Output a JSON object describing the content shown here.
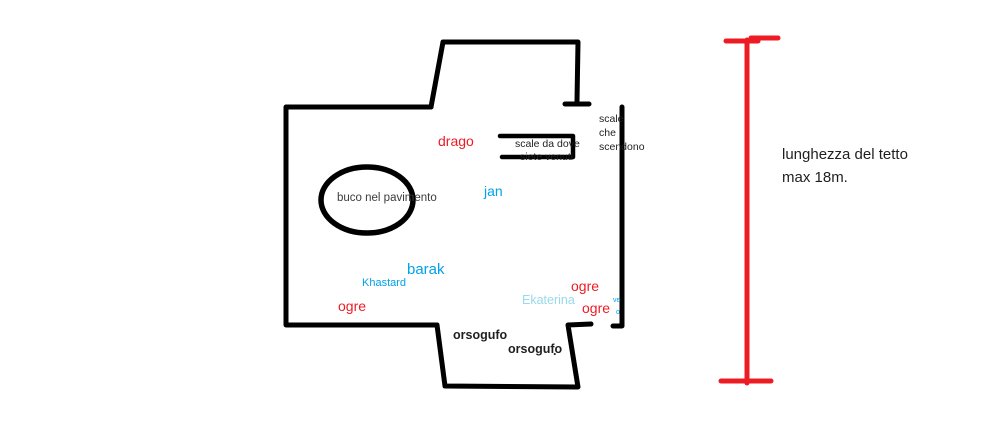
{
  "canvas": {
    "background": "#ffffff"
  },
  "colors": {
    "wall": "#000000",
    "marker_red": "#ed1c24",
    "marker_blue": "#00a2e8",
    "marker_light_blue": "#99d9ea",
    "note_dark": "#3c3c3c",
    "note_black": "#1f1f1f"
  },
  "floor_plan": {
    "hole_label": "buco nel pavimento",
    "stairs_entry": {
      "line1": "scale da dove",
      "line2": "siete venuti"
    },
    "stairs_down": {
      "line1": "scale",
      "line2": "che",
      "line3": "scendono"
    },
    "creatures": {
      "drago": "drago",
      "jan": "jan",
      "barak": "barak",
      "khastard": "Khastard",
      "ogre_left": "ogre",
      "ogre_top_right": "ogre",
      "ogre_bottom_right": "ogre",
      "ekaterina": "Ekaterina",
      "orsogufo_1": "orsogufo",
      "orsogufo_2": "orsogufo",
      "stray_dot": ".",
      "tiny_note_line1": "ve",
      "tiny_note_line2": "o"
    }
  },
  "measurement": {
    "line1": "lunghezza del tetto",
    "line2": "max 18m."
  }
}
